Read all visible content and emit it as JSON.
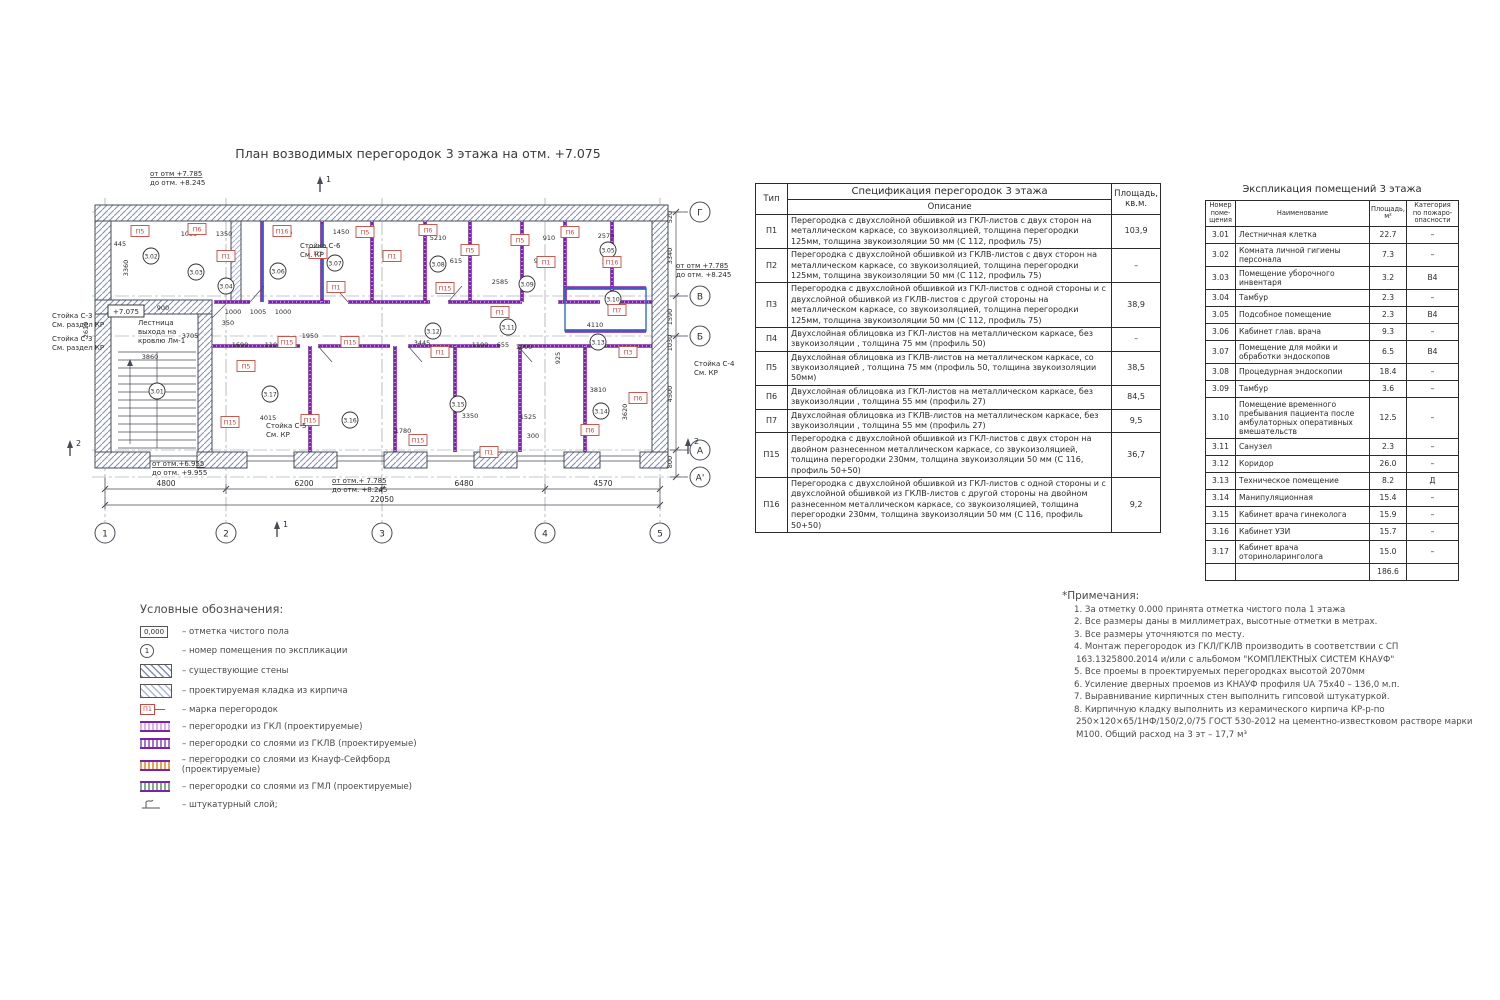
{
  "plan": {
    "title": "План возводимых перегородок 3 этажа на отм. +7.075",
    "elev_box": {
      "t": "+7.075",
      "x": 126,
      "y": 311
    },
    "axes_bottom": [
      {
        "l": "1",
        "x": 105
      },
      {
        "l": "2",
        "x": 226
      },
      {
        "l": "3",
        "x": 382
      },
      {
        "l": "4",
        "x": 545
      },
      {
        "l": "5",
        "x": 660
      }
    ],
    "axes_right": [
      {
        "l": "Г",
        "y": 212
      },
      {
        "l": "В",
        "y": 296
      },
      {
        "l": "Б",
        "y": 336
      },
      {
        "l": "А",
        "y": 450
      },
      {
        "l": "А'",
        "y": 477
      }
    ],
    "dims_axis_bottom": [
      {
        "t": "4800",
        "x": 166
      },
      {
        "t": "6200",
        "x": 304
      },
      {
        "t": "6480",
        "x": 464
      },
      {
        "t": "4570",
        "x": 603
      }
    ],
    "dim_total": {
      "t": "22050",
      "x": 382
    },
    "dims_right": [
      {
        "t": "520",
        "y": 217
      },
      {
        "t": "3340",
        "y": 256
      },
      {
        "t": "1590",
        "y": 317
      },
      {
        "t": "1030",
        "y": 343
      },
      {
        "t": "4500",
        "y": 394
      },
      {
        "t": "800",
        "y": 462
      }
    ],
    "rooms": [
      {
        "n": "3.01",
        "x": 157,
        "y": 391
      },
      {
        "n": "3.02",
        "x": 151,
        "y": 256
      },
      {
        "n": "3.03",
        "x": 196,
        "y": 272
      },
      {
        "n": "3.04",
        "x": 226,
        "y": 286
      },
      {
        "n": "3.05",
        "x": 608,
        "y": 250
      },
      {
        "n": "3.06",
        "x": 278,
        "y": 271
      },
      {
        "n": "3.07",
        "x": 335,
        "y": 263
      },
      {
        "n": "3.08",
        "x": 438,
        "y": 264
      },
      {
        "n": "3.09",
        "x": 527,
        "y": 284
      },
      {
        "n": "3.10",
        "x": 613,
        "y": 299
      },
      {
        "n": "3.11",
        "x": 508,
        "y": 327
      },
      {
        "n": "3.12",
        "x": 433,
        "y": 331
      },
      {
        "n": "3.13",
        "x": 598,
        "y": 342
      },
      {
        "n": "3.14",
        "x": 601,
        "y": 411
      },
      {
        "n": "3.15",
        "x": 458,
        "y": 404
      },
      {
        "n": "3.16",
        "x": 350,
        "y": 420
      },
      {
        "n": "3.17",
        "x": 270,
        "y": 394
      }
    ],
    "marks": [
      {
        "l": "П5",
        "x": 140,
        "y": 231
      },
      {
        "l": "П6",
        "x": 197,
        "y": 229
      },
      {
        "l": "П1",
        "x": 226,
        "y": 256
      },
      {
        "l": "П16",
        "x": 282,
        "y": 231
      },
      {
        "l": "П3",
        "x": 318,
        "y": 253
      },
      {
        "l": "П1",
        "x": 336,
        "y": 287
      },
      {
        "l": "П5",
        "x": 365,
        "y": 232
      },
      {
        "l": "П1",
        "x": 392,
        "y": 256
      },
      {
        "l": "П6",
        "x": 428,
        "y": 230
      },
      {
        "l": "П15",
        "x": 445,
        "y": 288
      },
      {
        "l": "П5",
        "x": 470,
        "y": 250
      },
      {
        "l": "П1",
        "x": 500,
        "y": 312
      },
      {
        "l": "П5",
        "x": 520,
        "y": 240
      },
      {
        "l": "П1",
        "x": 546,
        "y": 262
      },
      {
        "l": "П6",
        "x": 570,
        "y": 232
      },
      {
        "l": "П16",
        "x": 612,
        "y": 262
      },
      {
        "l": "П7",
        "x": 617,
        "y": 310
      },
      {
        "l": "П3",
        "x": 628,
        "y": 352
      },
      {
        "l": "П6",
        "x": 638,
        "y": 398
      },
      {
        "l": "П6",
        "x": 590,
        "y": 430
      },
      {
        "l": "П5",
        "x": 246,
        "y": 366
      },
      {
        "l": "П15",
        "x": 230,
        "y": 422
      },
      {
        "l": "П15",
        "x": 287,
        "y": 342
      },
      {
        "l": "П15",
        "x": 350,
        "y": 342
      },
      {
        "l": "П15",
        "x": 310,
        "y": 420
      },
      {
        "l": "П1",
        "x": 440,
        "y": 352
      },
      {
        "l": "П15",
        "x": 418,
        "y": 440
      },
      {
        "l": "П1",
        "x": 489,
        "y": 452
      }
    ],
    "dims": [
      {
        "t": "445",
        "x": 120,
        "y": 246
      },
      {
        "t": "1055",
        "x": 189,
        "y": 236
      },
      {
        "t": "1350",
        "x": 224,
        "y": 236
      },
      {
        "t": "2770",
        "x": 284,
        "y": 235
      },
      {
        "t": "1450",
        "x": 341,
        "y": 234
      },
      {
        "t": "5210",
        "x": 438,
        "y": 240
      },
      {
        "t": "910",
        "x": 549,
        "y": 240
      },
      {
        "t": "2570",
        "x": 606,
        "y": 238
      },
      {
        "t": "2620",
        "x": 610,
        "y": 264
      },
      {
        "t": "615",
        "x": 456,
        "y": 263
      },
      {
        "t": "900",
        "x": 540,
        "y": 263
      },
      {
        "t": "2585",
        "x": 500,
        "y": 284
      },
      {
        "t": "900",
        "x": 163,
        "y": 310
      },
      {
        "t": "350",
        "x": 228,
        "y": 325
      },
      {
        "t": "1000",
        "x": 233,
        "y": 314
      },
      {
        "t": "1005",
        "x": 258,
        "y": 314
      },
      {
        "t": "1000",
        "x": 283,
        "y": 314
      },
      {
        "t": "3705",
        "x": 190,
        "y": 338
      },
      {
        "t": "1950",
        "x": 310,
        "y": 338
      },
      {
        "t": "1690",
        "x": 240,
        "y": 347
      },
      {
        "t": "1100",
        "x": 273,
        "y": 347
      },
      {
        "t": "3445",
        "x": 422,
        "y": 345
      },
      {
        "t": "1100",
        "x": 480,
        "y": 347
      },
      {
        "t": "655",
        "x": 503,
        "y": 347
      },
      {
        "t": "1000",
        "x": 524,
        "y": 349
      },
      {
        "t": "4110",
        "x": 595,
        "y": 327
      },
      {
        "t": "3860",
        "x": 150,
        "y": 359
      },
      {
        "t": "4015",
        "x": 268,
        "y": 420
      },
      {
        "t": "3350",
        "x": 470,
        "y": 418
      },
      {
        "t": "1780",
        "x": 403,
        "y": 433
      },
      {
        "t": "3810",
        "x": 598,
        "y": 392
      },
      {
        "t": "1525",
        "x": 528,
        "y": 419
      },
      {
        "t": "300",
        "x": 533,
        "y": 438
      },
      {
        "t": "925",
        "x": 560,
        "y": 358,
        "r": 90
      },
      {
        "t": "3620",
        "x": 627,
        "y": 412,
        "r": 90
      },
      {
        "t": "2610",
        "x": 88,
        "y": 330,
        "r": 90
      },
      {
        "t": "3360",
        "x": 128,
        "y": 268,
        "r": 90
      }
    ],
    "annotations": [
      {
        "lines": [
          "от отм +7.785",
          "до отм. +8.245"
        ],
        "x": 150,
        "y": 176,
        "u": true
      },
      {
        "lines": [
          "от отм +7.785",
          "до отм. +8.245"
        ],
        "x": 676,
        "y": 268,
        "u": true
      },
      {
        "lines": [
          "от отм.+6.955",
          "до отм. +9.955"
        ],
        "x": 152,
        "y": 466,
        "u": true
      },
      {
        "lines": [
          "от отм.+ 7.785",
          "до отм. +8.245"
        ],
        "x": 332,
        "y": 483,
        "u": true
      },
      {
        "lines": [
          "Стойка С-3",
          "См. раздел КР"
        ],
        "x": 52,
        "y": 318
      },
      {
        "lines": [
          "Стойка С-3",
          "См. раздел КР"
        ],
        "x": 52,
        "y": 341
      },
      {
        "lines": [
          "Стойка С-4",
          "См. КР"
        ],
        "x": 694,
        "y": 366
      },
      {
        "lines": [
          "Стойка С-5",
          "См. КР"
        ],
        "x": 266,
        "y": 428
      },
      {
        "lines": [
          "Стойка С-6",
          "См. КР"
        ],
        "x": 300,
        "y": 248
      },
      {
        "lines": [
          "Лестница",
          "выхода на",
          "кровлю Лм-1"
        ],
        "x": 138,
        "y": 325
      }
    ],
    "section_marks": [
      {
        "l": "1",
        "x": 320,
        "y": 176
      },
      {
        "l": "1",
        "x": 277,
        "y": 521
      },
      {
        "l": "2",
        "x": 70,
        "y": 440
      },
      {
        "l": "2",
        "x": 688,
        "y": 438
      }
    ]
  },
  "spec_table": {
    "title": "Спецификация перегородок 3 этажа",
    "col_type": "Тип",
    "col_desc": "Описание",
    "col_area": "Площадь,\nкв.м.",
    "rows": [
      {
        "type": "П1",
        "desc": "Перегородка с двухслойной обшивкой из ГКЛ-листов с двух сторон на металлическом каркасе, со звукоизоляцией, толщина перегородки 125мм, толщина звукоизоляции 50 мм (С 112, профиль 75)",
        "area": "103,9"
      },
      {
        "type": "П2",
        "desc": "Перегородка с двухслойной обшивкой из ГКЛВ-листов с двух сторон на металлическом каркасе, со звукоизоляцией, толщина перегородки 125мм, толщина звукоизоляции 50 мм (С 112, профиль 75)",
        "area": "–"
      },
      {
        "type": "П3",
        "desc": "Перегородка с двухслойной обшивкой из ГКЛ-листов с одной стороны и  с двухслойной обшивкой из ГКЛВ-листов с другой стороны на металлическом каркасе, со звукоизоляцией, толщина перегородки 125мм, толщина звукоизоляции 50 мм (С 112, профиль 75)",
        "area": "38,9"
      },
      {
        "type": "П4",
        "desc": "Двухслойная облицовка из ГКЛ-листов на металлическом каркасе, без звукоизоляции , толщина 75 мм (профиль 50)",
        "area": "–"
      },
      {
        "type": "П5",
        "desc": "Двухслойная облицовка из ГКЛВ-листов на металлическом каркасе, со звукоизоляцией , толщина 75 мм (профиль 50, толщина звукоизоляции 50мм)",
        "area": "38,5"
      },
      {
        "type": "П6",
        "desc": "Двухслойная облицовка из ГКЛ-листов на металлическом каркасе, без звукоизоляции , толщина 55 мм (профиль 27)",
        "area": "84,5"
      },
      {
        "type": "П7",
        "desc": "Двухслойная облицовка из ГКЛВ-листов на металлическом каркасе, без звукоизоляции , толщина 55 мм (профиль 27)",
        "area": "9,5"
      },
      {
        "type": "П15",
        "desc": "Перегородка с двухслойной обшивкой из ГКЛ-листов с двух сторон на двойном разнесенном металлическом каркасе, со звукоизоляцией, толщина перегородки 230мм, толщина звукоизоляции 50 мм (С 116, профиль 50+50)",
        "area": "36,7"
      },
      {
        "type": "П16",
        "desc": "Перегородка с двухслойной обшивкой из ГКЛ-листов с одной стороны и  с двухслойной обшивкой из ГКЛВ-листов с другой стороны на двойном разнесенном металлическом каркасе, со звукоизоляцией, толщина перегородки 230мм, толщина звукоизоляции 50 мм (С 116, профиль 50+50)",
        "area": "9,2"
      }
    ]
  },
  "rooms_table": {
    "title": "Экспликация  помещений 3 этажа",
    "col_num": "Номер\nпоме-\nщения",
    "col_name": "Наименование",
    "col_area": "Площадь,\nм²",
    "col_cat": "Категория\nпо пожаро-\nопасности",
    "rows": [
      {
        "num": "3.01",
        "name": "Лестничная клетка",
        "area": "22.7",
        "cat": "–"
      },
      {
        "num": "3.02",
        "name": "Комната личной гигиены персонала",
        "area": "7.3",
        "cat": "–"
      },
      {
        "num": "3.03",
        "name": "Помещение уборочного инвентаря",
        "area": "3.2",
        "cat": "В4"
      },
      {
        "num": "3.04",
        "name": "Тамбур",
        "area": "2.3",
        "cat": "–"
      },
      {
        "num": "3.05",
        "name": "Подсобное помещение",
        "area": "2.3",
        "cat": "В4"
      },
      {
        "num": "3.06",
        "name": "Кабинет глав. врача",
        "area": "9.3",
        "cat": "–"
      },
      {
        "num": "3.07",
        "name": "Помещение для мойки и обработки эндоскопов",
        "area": "6.5",
        "cat": "В4"
      },
      {
        "num": "3.08",
        "name": "Процедурная эндоскопии",
        "area": "18.4",
        "cat": "–"
      },
      {
        "num": "3.09",
        "name": "Тамбур",
        "area": "3.6",
        "cat": "–"
      },
      {
        "num": "3.10",
        "name": "Помещение временного пребывания пациента после амбулаторных оперативных вмешательств",
        "area": "12.5",
        "cat": "–"
      },
      {
        "num": "3.11",
        "name": "Санузел",
        "area": "2.3",
        "cat": "–"
      },
      {
        "num": "3.12",
        "name": "Коридор",
        "area": "26.0",
        "cat": "–"
      },
      {
        "num": "3.13",
        "name": "Техническое помещение",
        "area": "8.2",
        "cat": "Д"
      },
      {
        "num": "3.14",
        "name": "Манипуляционная",
        "area": "15.4",
        "cat": "–"
      },
      {
        "num": "3.15",
        "name": "Кабинет врача гинеколога",
        "area": "15.9",
        "cat": "–"
      },
      {
        "num": "3.16",
        "name": "Кабинет УЗИ",
        "area": "15.7",
        "cat": "–"
      },
      {
        "num": "3.17",
        "name": "Кабинет врача оториноларинголога",
        "area": "15.0",
        "cat": "–"
      }
    ],
    "total": "186.6"
  },
  "legend": {
    "title": "Условные обозначения:",
    "items": [
      {
        "swatch": "elev-box",
        "symbol": "0,000",
        "label": "– отметка чистого пола"
      },
      {
        "swatch": "room-circle",
        "symbol": "1",
        "label": "– номер помещения по экспликации"
      },
      {
        "swatch": "hatch-existing",
        "label": "– существующие стены"
      },
      {
        "swatch": "hatch-brick",
        "label": "– проектируемая кладка из кирпича"
      },
      {
        "swatch": "mark-box",
        "symbol": "П1",
        "label": "– марка перегородок"
      },
      {
        "swatch": "band-gkl",
        "label": "– перегородки из ГКЛ (проектируемые)"
      },
      {
        "swatch": "band-gklv",
        "label": "– перегородки со слоями из ГКЛВ (проектируемые)"
      },
      {
        "swatch": "band-ks",
        "label": "– перегородки со слоями из Кнауф-Сейфборд (проектируемые)"
      },
      {
        "swatch": "band-gml",
        "label": "– перегородки со слоями из ГМЛ (проектируемые)"
      },
      {
        "swatch": "plaster",
        "label": "– штукатурный слой;"
      }
    ]
  },
  "notes": {
    "title": "*Примечания:",
    "items": [
      "1.    За отметку 0.000 принята отметка чистого пола 1 этажа",
      "2.    Все размеры даны в миллиметрах, высотные отметки в метрах.",
      "3.    Все размеры уточняются по месту.",
      "4.    Монтаж перегородок из ГКЛ/ГКЛВ производить в соответствии с СП 163.1325800.2014 и/или с альбомом \"КОМПЛЕКТНЫХ СИСТЕМ КНАУФ\"",
      "5. Все проемы в проектируемых перегородках высотой 2070мм",
      "6.  Усиление дверных проемов из КНАУФ профиля UA 75x40 – 136,0 м.п.",
      "7. Выравнивание кирпичных стен выполнить гипсовой штукатуркой.",
      "8. Кирпичную кладку выполнить из керамического кирпича КР-р-по 250×120×65/1НФ/150/2,0/75 ГОСТ 530-2012 на цементно-известковом растворе марки М100. Общий расход на 3 эт – 17,7 м³"
    ]
  },
  "colors": {
    "partition_purple": "#7b22a8",
    "mark_red": "#bf4b42",
    "highlight_blue": "#2f6fc4",
    "hatch_blue_gray": "#7f8dbb"
  }
}
